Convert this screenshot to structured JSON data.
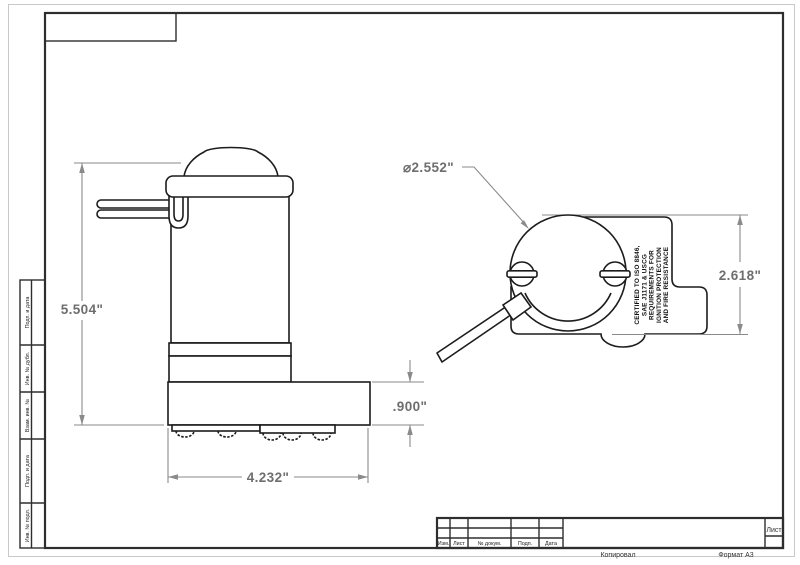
{
  "page": {
    "copy_label": "Копировал",
    "format_label": "Формат А3"
  },
  "frame": {
    "side_labels": [
      "Подп. и дата",
      "Инв. № дубл.",
      "Взам. инв. №",
      "Подп. и дата",
      "Инв. № подл."
    ],
    "title_block": {
      "columns": [
        "Изм.",
        "Лист",
        "№ докум.",
        "Подп.",
        "Дата"
      ],
      "sheet_label": "Лист"
    }
  },
  "views": {
    "side_view": {
      "dims": {
        "height": "5.504\"",
        "width": "4.232\"",
        "base_height": ".900\""
      }
    },
    "end_view": {
      "dims": {
        "diameter": "⌀2.552\"",
        "height": "2.618\""
      },
      "cert_lines": [
        "CERTIFIED TO ISO 8846,",
        "SAE J1171 & USCG",
        "REQUIREMENTS FOR",
        "IGNITION PROTECTION",
        "AND FIRE RESISTANCE"
      ]
    }
  },
  "colors": {
    "outline": "#1c1c1c",
    "dimension": "#8a8a8a",
    "dim_text": "#6e6e6e",
    "frame": "#2e2e2e"
  }
}
